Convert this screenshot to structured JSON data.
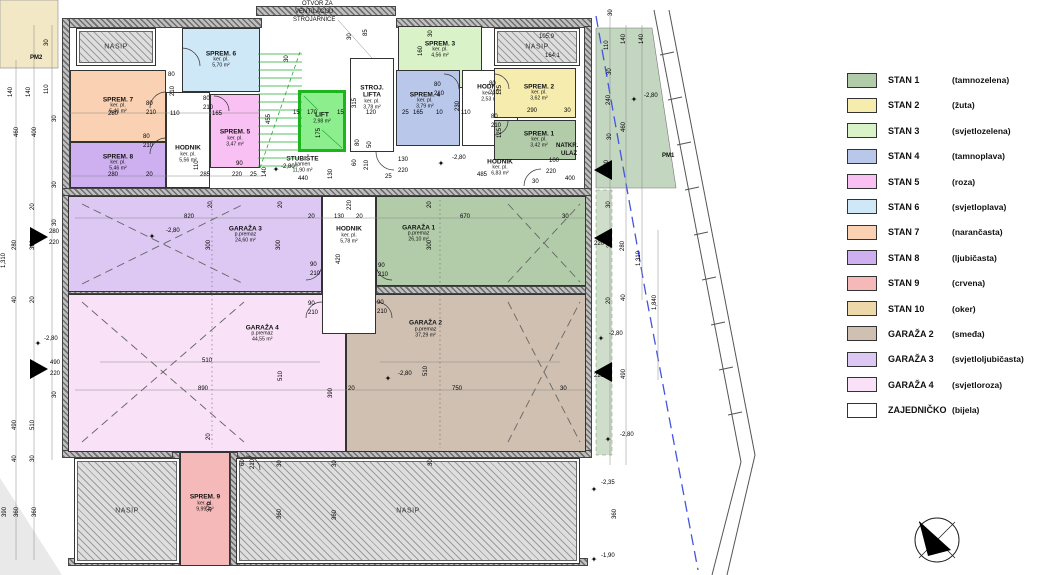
{
  "colors": {
    "stan1": "#b2ccaa",
    "stan2": "#f6ecae",
    "stan3": "#d9f2c7",
    "stan4": "#b9c8ea",
    "stan5": "#f9c0f3",
    "stan6": "#cee8f8",
    "stan7": "#fad2b3",
    "stan8": "#ceb0f0",
    "stan9": "#f6b9ba",
    "stan10": "#ecd8a8",
    "garaza2": "#cfc0b2",
    "garaza3": "#dcc8f2",
    "garaza4": "#f9e2f7",
    "white": "#ffffff",
    "lift": "#8cee8c",
    "site_green": "#c3d6c0",
    "site_yellow": "#f2e8c5",
    "boundary_blue": "#4455dd",
    "stair_green": "#22aa33"
  },
  "legend": {
    "items": [
      {
        "label": "STAN 1",
        "cname": "(tamnozelena)",
        "color": "stan1"
      },
      {
        "label": "STAN 2",
        "cname": "(žuta)",
        "color": "stan2"
      },
      {
        "label": "STAN 3",
        "cname": "(svjetlozelena)",
        "color": "stan3"
      },
      {
        "label": "STAN 4",
        "cname": "(tamnoplava)",
        "color": "stan4"
      },
      {
        "label": "STAN 5",
        "cname": "(roza)",
        "color": "stan5"
      },
      {
        "label": "STAN 6",
        "cname": "(svjetloplava)",
        "color": "stan6"
      },
      {
        "label": "STAN 7",
        "cname": "(narančasta)",
        "color": "stan7"
      },
      {
        "label": "STAN 8",
        "cname": "(ljubičasta)",
        "color": "stan8"
      },
      {
        "label": "STAN 9",
        "cname": "(crvena)",
        "color": "stan9"
      },
      {
        "label": "STAN 10",
        "cname": "(oker)",
        "color": "stan10"
      },
      {
        "label": "GARAŽA 2",
        "cname": "(smeđa)",
        "color": "garaza2"
      },
      {
        "label": "GARAŽA 3",
        "cname": "(svjetloljubičasta)",
        "color": "garaza3"
      },
      {
        "label": "GARAŽA 4",
        "cname": "(svjetloroza)",
        "color": "garaza4"
      },
      {
        "label": "ZAJEDNIČKO",
        "cname": "(bijela)",
        "color": "white"
      }
    ]
  },
  "rooms": [
    {
      "id": "garaza-3",
      "nm": "GARAŽA 3",
      "s1": "p.premaz",
      "s2": "24,60 m²",
      "x": 68,
      "y": 196,
      "w": 254,
      "h": 96,
      "fill": "garaza3",
      "lx": 0.7,
      "ly": 0.4
    },
    {
      "id": "garaza-1",
      "nm": "GARAŽA 1",
      "s1": "p.premaz",
      "s2": "26,10 m²",
      "x": 376,
      "y": 196,
      "w": 210,
      "h": 90,
      "fill": "stan1",
      "lx": 0.2,
      "ly": 0.42
    },
    {
      "id": "garaza-4",
      "nm": "GARAŽA 4",
      "s1": "p.premaz",
      "s2": "44,55 m²",
      "x": 68,
      "y": 294,
      "w": 278,
      "h": 158,
      "fill": "garaza4",
      "lx": 0.7,
      "ly": 0.25
    },
    {
      "id": "garaza-2",
      "nm": "GARAŽA 2",
      "s1": "p.premaz",
      "s2": "37,29 m²",
      "x": 346,
      "y": 294,
      "w": 240,
      "h": 158,
      "fill": "garaza2",
      "lx": 0.33,
      "ly": 0.22
    },
    {
      "id": "hodnik-center",
      "nm": "HODNIK",
      "s1": "ker. pl.",
      "s2": "5,78 m²",
      "x": 322,
      "y": 196,
      "w": 54,
      "h": 138,
      "fill": "white",
      "lx": 0.5,
      "ly": 0.28
    },
    {
      "id": "sprem-6",
      "nm": "SPREM. 6",
      "s1": "ker. pl.",
      "s2": "5,70 m²",
      "x": 182,
      "y": 28,
      "w": 78,
      "h": 64,
      "fill": "stan6",
      "lx": 0.5,
      "ly": 0.5
    },
    {
      "id": "sprem-7",
      "nm": "SPREM. 7",
      "s1": "ker. pl.",
      "s2": "5,46 m²",
      "x": 70,
      "y": 70,
      "w": 96,
      "h": 72,
      "fill": "stan7",
      "lx": 0.5,
      "ly": 0.5
    },
    {
      "id": "sprem-8",
      "nm": "SPREM. 8",
      "s1": "ker. pl.",
      "s2": "5,46 m²",
      "x": 70,
      "y": 142,
      "w": 96,
      "h": 46,
      "fill": "stan8",
      "lx": 0.5,
      "ly": 0.45
    },
    {
      "id": "hodnik-spremista",
      "nm": "HODNIK",
      "s1": "ker. pl.",
      "s2": "5,56 m²",
      "x": 166,
      "y": 92,
      "w": 44,
      "h": 96,
      "fill": "white",
      "lx": 0.5,
      "ly": 0.65
    },
    {
      "id": "sprem-5",
      "nm": "SPREM. 5",
      "s1": "ker. pl.",
      "s2": "3,47 m²",
      "x": 210,
      "y": 94,
      "w": 50,
      "h": 74,
      "fill": "stan5",
      "lx": 0.5,
      "ly": 0.6
    },
    {
      "id": "stroj-lifta",
      "nm": "STROJ. LIFTA",
      "s1": "ker. pl.",
      "s2": "3,78 m²",
      "x": 350,
      "y": 58,
      "w": 44,
      "h": 94,
      "fill": "white",
      "lx": 0.5,
      "ly": 0.42,
      "wrap": true
    },
    {
      "id": "lift",
      "nm": "LIFT",
      "s1": "2,98 m²",
      "s2": "",
      "x": 298,
      "y": 90,
      "w": 48,
      "h": 62,
      "fill": "lift",
      "lx": 0.5,
      "ly": 0.45,
      "thick": true
    },
    {
      "id": "sprem-3",
      "nm": "SPREM. 3",
      "s1": "ker. pl.",
      "s2": "4,56 m²",
      "x": 398,
      "y": 26,
      "w": 84,
      "h": 62,
      "fill": "stan3",
      "lx": 0.5,
      "ly": 0.38
    },
    {
      "id": "sprem-4",
      "nm": "SPREM. 4",
      "s1": "ker. pl.",
      "s2": "3,79 m²",
      "x": 396,
      "y": 70,
      "w": 64,
      "h": 76,
      "fill": "stan4",
      "lx": 0.45,
      "ly": 0.4
    },
    {
      "id": "hodnik-top-right",
      "nm": "HODNIK",
      "s1": "ker. pl.",
      "s2": "2,53 m²",
      "x": 462,
      "y": 70,
      "w": 56,
      "h": 76,
      "fill": "white",
      "lx": 0.5,
      "ly": 0.3
    },
    {
      "id": "sprem-2",
      "nm": "SPREM. 2",
      "s1": "ker. pl.",
      "s2": "3,62 m²",
      "x": 494,
      "y": 68,
      "w": 82,
      "h": 50,
      "fill": "stan2",
      "lx": 0.55,
      "ly": 0.5
    },
    {
      "id": "sprem-1",
      "nm": "SPREM. 1",
      "s1": "ker. pl.",
      "s2": "3,42 m²",
      "x": 494,
      "y": 120,
      "w": 82,
      "h": 40,
      "fill": "stan1",
      "lx": 0.55,
      "ly": 0.5
    },
    {
      "id": "stubiste",
      "nm": "STUBIŠTE",
      "s1": "kamen",
      "s2": "11,90 m²",
      "x": 275,
      "y": 150,
      "w": 55,
      "h": 30,
      "fill": "white",
      "lx": 0.5,
      "ly": 0.5,
      "noborder": true
    },
    {
      "id": "hodnik-ulaz",
      "nm": "HODNIK",
      "s1": "ker. pl.",
      "s2": "6,83 m²",
      "x": 470,
      "y": 155,
      "w": 60,
      "h": 26,
      "fill": "white",
      "lx": 0.5,
      "ly": 0.5,
      "noborder": true
    },
    {
      "id": "sprem-9",
      "nm": "SPREM. 9",
      "s1": "ker. pl.",
      "s2": "9,99 m²",
      "x": 180,
      "y": 452,
      "w": 50,
      "h": 114,
      "fill": "stan9",
      "lx": 0.5,
      "ly": 0.45
    }
  ],
  "nasip_blocks": [
    {
      "label": "NASIP",
      "x": 76,
      "y": 28,
      "w": 80,
      "h": 38
    },
    {
      "label": "NASIP",
      "x": 494,
      "y": 28,
      "w": 86,
      "h": 38
    },
    {
      "label": "NASIP",
      "x": 74,
      "y": 458,
      "w": 106,
      "h": 106
    },
    {
      "label": "NASIP",
      "x": 236,
      "y": 458,
      "w": 344,
      "h": 106
    }
  ],
  "walls": [
    [
      62,
      18,
      200,
      10
    ],
    [
      256,
      6,
      140,
      10
    ],
    [
      396,
      18,
      196,
      10
    ],
    [
      62,
      18,
      8,
      440
    ],
    [
      584,
      26,
      8,
      432
    ],
    [
      62,
      188,
      530,
      8
    ],
    [
      68,
      286,
      254,
      8
    ],
    [
      376,
      286,
      210,
      8
    ],
    [
      62,
      450,
      530,
      8
    ],
    [
      68,
      558,
      520,
      8
    ],
    [
      230,
      452,
      8,
      114
    ],
    [
      172,
      452,
      8,
      114
    ]
  ],
  "notes": [
    {
      "t": "OTVOR ZA",
      "x": 302,
      "y": 1
    },
    {
      "t": "VENTILACIJU",
      "x": 295,
      "y": 9
    },
    {
      "t": "STROJARNICE",
      "x": 293,
      "y": 17
    },
    {
      "t": "NATKR.",
      "x": 556,
      "y": 143,
      "b": 1
    },
    {
      "t": "ULAZ",
      "x": 561,
      "y": 151,
      "b": 1
    },
    {
      "t": "PM1",
      "x": 662,
      "y": 153,
      "b": 1
    },
    {
      "t": "PM2",
      "x": 30,
      "y": 55,
      "b": 1
    },
    {
      "t": "105,9",
      "x": 539,
      "y": 34
    },
    {
      "t": "164,1",
      "x": 545,
      "y": 53
    }
  ],
  "dims": [
    [
      "140",
      8,
      85,
      1
    ],
    [
      "140",
      26,
      85,
      1
    ],
    [
      "110",
      44,
      82,
      1
    ],
    [
      "30",
      44,
      36,
      1
    ],
    [
      "30",
      52,
      112,
      1
    ],
    [
      "460",
      14,
      125,
      1
    ],
    [
      "400",
      32,
      125,
      1
    ],
    [
      "30",
      52,
      178,
      1
    ],
    [
      "20",
      30,
      200,
      1
    ],
    [
      "30",
      52,
      216,
      1
    ],
    [
      "280",
      12,
      238,
      1
    ],
    [
      "300",
      30,
      238,
      1
    ],
    [
      "280",
      49,
      229
    ],
    [
      "220",
      49,
      240
    ],
    [
      "1,310",
      1,
      252,
      1
    ],
    [
      "40",
      12,
      293,
      1
    ],
    [
      "20",
      30,
      293,
      1
    ],
    [
      "-2,80",
      44,
      336
    ],
    [
      "490",
      50,
      360
    ],
    [
      "220",
      50,
      371
    ],
    [
      "30",
      52,
      388,
      1
    ],
    [
      "490",
      12,
      418,
      1
    ],
    [
      "510",
      30,
      418,
      1
    ],
    [
      "40",
      12,
      452,
      1
    ],
    [
      "30",
      30,
      452,
      1
    ],
    [
      "390",
      2,
      505,
      1
    ],
    [
      "360",
      14,
      505,
      1
    ],
    [
      "360",
      32,
      505,
      1
    ],
    [
      "280",
      108,
      111
    ],
    [
      "110",
      170,
      111
    ],
    [
      "165",
      212,
      111
    ],
    [
      "280",
      108,
      172
    ],
    [
      "20",
      146,
      172
    ],
    [
      "110",
      194,
      158,
      1
    ],
    [
      "285",
      200,
      172
    ],
    [
      "90",
      236,
      161
    ],
    [
      "220",
      232,
      172
    ],
    [
      "25",
      250,
      172
    ],
    [
      "140",
      262,
      165,
      1
    ],
    [
      "80",
      168,
      72
    ],
    [
      "210",
      170,
      84,
      1
    ],
    [
      "80",
      146,
      101
    ],
    [
      "210",
      146,
      110
    ],
    [
      "80",
      143,
      134
    ],
    [
      "210",
      143,
      143
    ],
    [
      "80",
      203,
      96
    ],
    [
      "210",
      203,
      105
    ],
    [
      "30",
      284,
      52,
      1
    ],
    [
      "455",
      266,
      112,
      1
    ],
    [
      "15",
      293,
      110
    ],
    [
      "170",
      307,
      110
    ],
    [
      "15",
      337,
      110
    ],
    [
      "175",
      316,
      126,
      1
    ],
    [
      "315",
      352,
      96,
      1
    ],
    [
      "30",
      347,
      30,
      1
    ],
    [
      "85",
      363,
      26,
      1
    ],
    [
      "120",
      366,
      110
    ],
    [
      "-2,80",
      281,
      164
    ],
    [
      "130",
      328,
      167,
      1
    ],
    [
      "440",
      298,
      176
    ],
    [
      "80",
      355,
      136,
      1
    ],
    [
      "50",
      367,
      138,
      1
    ],
    [
      "60",
      352,
      156,
      1
    ],
    [
      "210",
      364,
      158,
      1
    ],
    [
      "25",
      385,
      174
    ],
    [
      "130",
      398,
      157
    ],
    [
      "220",
      398,
      168
    ],
    [
      "160",
      418,
      44,
      1
    ],
    [
      "30",
      428,
      27,
      1
    ],
    [
      "25",
      402,
      110
    ],
    [
      "165",
      413,
      110
    ],
    [
      "10",
      436,
      110
    ],
    [
      "230",
      455,
      99,
      1
    ],
    [
      "110",
      461,
      110
    ],
    [
      "80",
      434,
      82
    ],
    [
      "210",
      434,
      91
    ],
    [
      "80",
      489,
      81
    ],
    [
      "210",
      489,
      90
    ],
    [
      "80",
      491,
      114
    ],
    [
      "210",
      491,
      123
    ],
    [
      "125",
      497,
      83,
      1
    ],
    [
      "290",
      527,
      108
    ],
    [
      "30",
      564,
      108
    ],
    [
      "125",
      497,
      126,
      1
    ],
    [
      "-2,80",
      452,
      155
    ],
    [
      "485",
      477,
      172
    ],
    [
      "100",
      549,
      158
    ],
    [
      "220",
      546,
      169
    ],
    [
      "30",
      532,
      179
    ],
    [
      "400",
      565,
      176
    ],
    [
      "30",
      608,
      6,
      1
    ],
    [
      "110",
      604,
      38,
      1
    ],
    [
      "140",
      621,
      32,
      1
    ],
    [
      "140",
      639,
      32,
      1
    ],
    [
      "30",
      607,
      65,
      1
    ],
    [
      "240",
      606,
      93,
      1
    ],
    [
      "-2,80",
      644,
      93
    ],
    [
      "30",
      607,
      130,
      1
    ],
    [
      "460",
      621,
      120,
      1
    ],
    [
      "120",
      604,
      158,
      1
    ],
    [
      "30",
      606,
      198,
      1
    ],
    [
      "300",
      607,
      236,
      1
    ],
    [
      "280",
      620,
      239,
      1
    ],
    [
      "1,310",
      636,
      250,
      1
    ],
    [
      "1,840",
      652,
      294,
      1
    ],
    [
      "220",
      594,
      241
    ],
    [
      "20",
      606,
      294,
      1
    ],
    [
      "40",
      621,
      291,
      1
    ],
    [
      "-2,80",
      609,
      331
    ],
    [
      "510",
      606,
      365,
      1
    ],
    [
      "490",
      621,
      367,
      1
    ],
    [
      "220",
      594,
      373
    ],
    [
      "-2,80",
      620,
      432
    ],
    [
      "-2,35",
      601,
      480
    ],
    [
      "360",
      612,
      507,
      1
    ],
    [
      "-1,90",
      601,
      553
    ],
    [
      "820",
      184,
      214
    ],
    [
      "20",
      208,
      198,
      1
    ],
    [
      "20",
      278,
      198,
      1
    ],
    [
      "-2,80",
      166,
      228
    ],
    [
      "300",
      206,
      238,
      1
    ],
    [
      "300",
      276,
      238,
      1
    ],
    [
      "20",
      308,
      214
    ],
    [
      "130",
      334,
      214
    ],
    [
      "20",
      356,
      214
    ],
    [
      "670",
      460,
      214
    ],
    [
      "30",
      562,
      214
    ],
    [
      "220",
      347,
      198,
      1
    ],
    [
      "420",
      336,
      252,
      1
    ],
    [
      "20",
      427,
      198,
      1
    ],
    [
      "300",
      427,
      238,
      1
    ],
    [
      "90",
      310,
      262
    ],
    [
      "210",
      310,
      271
    ],
    [
      "90",
      308,
      301
    ],
    [
      "210",
      308,
      310
    ],
    [
      "90",
      378,
      263
    ],
    [
      "210",
      378,
      272
    ],
    [
      "90",
      377,
      300
    ],
    [
      "210",
      377,
      309
    ],
    [
      "510",
      202,
      358
    ],
    [
      "510",
      278,
      369,
      1
    ],
    [
      "890",
      198,
      386
    ],
    [
      "20",
      206,
      430,
      1
    ],
    [
      "-2,80",
      398,
      371
    ],
    [
      "510",
      423,
      364,
      1
    ],
    [
      "750",
      452,
      386
    ],
    [
      "30",
      560,
      386
    ],
    [
      "20",
      348,
      386
    ],
    [
      "390",
      328,
      386,
      1
    ],
    [
      "60",
      240,
      456,
      1
    ],
    [
      "210",
      250,
      457,
      1
    ],
    [
      "370",
      207,
      500,
      1
    ],
    [
      "30",
      277,
      457,
      1
    ],
    [
      "360",
      277,
      507,
      1
    ],
    [
      "30",
      332,
      457,
      1
    ],
    [
      "360",
      332,
      508,
      1
    ],
    [
      "30",
      428,
      456,
      1
    ]
  ],
  "level_stars": [
    [
      152,
      237
    ],
    [
      38,
      344
    ],
    [
      276,
      170
    ],
    [
      441,
      164
    ],
    [
      388,
      379
    ],
    [
      634,
      100
    ],
    [
      601,
      339
    ],
    [
      608,
      440
    ],
    [
      594,
      490
    ],
    [
      594,
      560
    ]
  ]
}
